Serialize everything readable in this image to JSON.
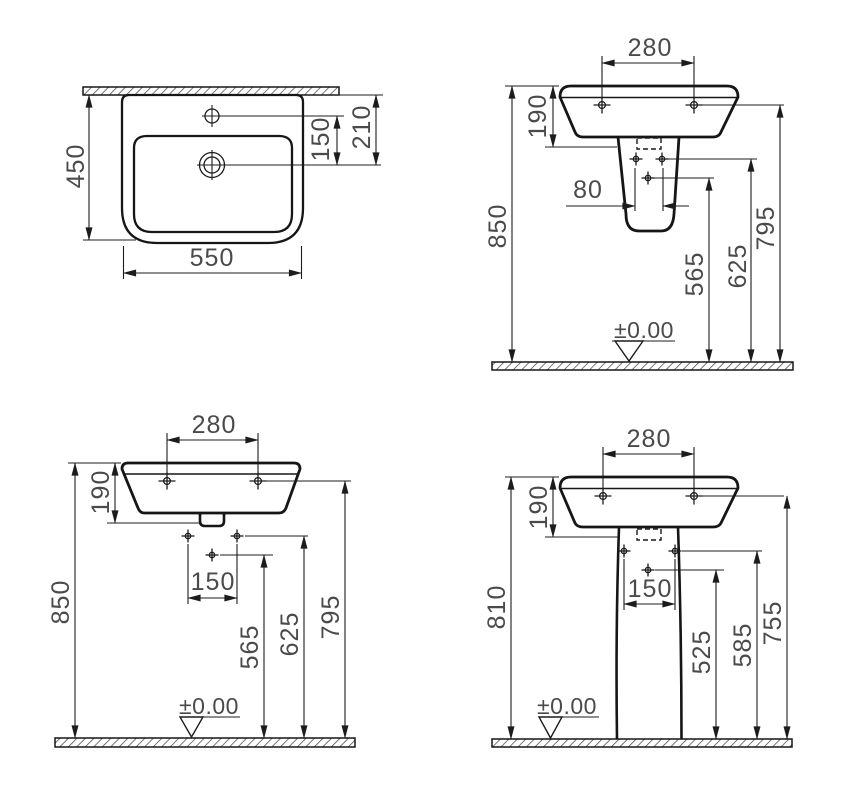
{
  "page": {
    "background": "#ffffff",
    "line_color": "#1c1c1c",
    "text_color": "#4a4a4a",
    "description_units": "mm"
  },
  "views": {
    "plan": {
      "dim_depth": "450",
      "dim_width": "550",
      "dim_tap_to_drain": "150",
      "dim_wall_to_drain": "210"
    },
    "semi_pedestal": {
      "dim_hole_spacing": "280",
      "dim_basin_height": "190",
      "dim_pedestal_hole_spacing": "80",
      "dim_floor_to_center_hole": "565",
      "dim_floor_to_pedestal_holes": "625",
      "dim_floor_to_basin_holes": "795",
      "dim_floor_to_rim": "850",
      "datum_label": "±0.00"
    },
    "wall_hung": {
      "dim_hole_spacing": "280",
      "dim_basin_height": "190",
      "dim_fixing_hole_spacing": "150",
      "dim_floor_to_center_hole": "565",
      "dim_floor_to_fixing_holes": "625",
      "dim_floor_to_basin_holes": "795",
      "dim_floor_to_rim": "850",
      "datum_label": "±0.00"
    },
    "full_pedestal": {
      "dim_hole_spacing": "280",
      "dim_basin_height": "190",
      "dim_fixing_hole_spacing": "150",
      "dim_floor_to_center_hole": "525",
      "dim_floor_to_fixing_holes": "585",
      "dim_floor_to_basin_holes": "755",
      "dim_floor_to_rim": "810",
      "datum_label": "±0.00"
    }
  }
}
